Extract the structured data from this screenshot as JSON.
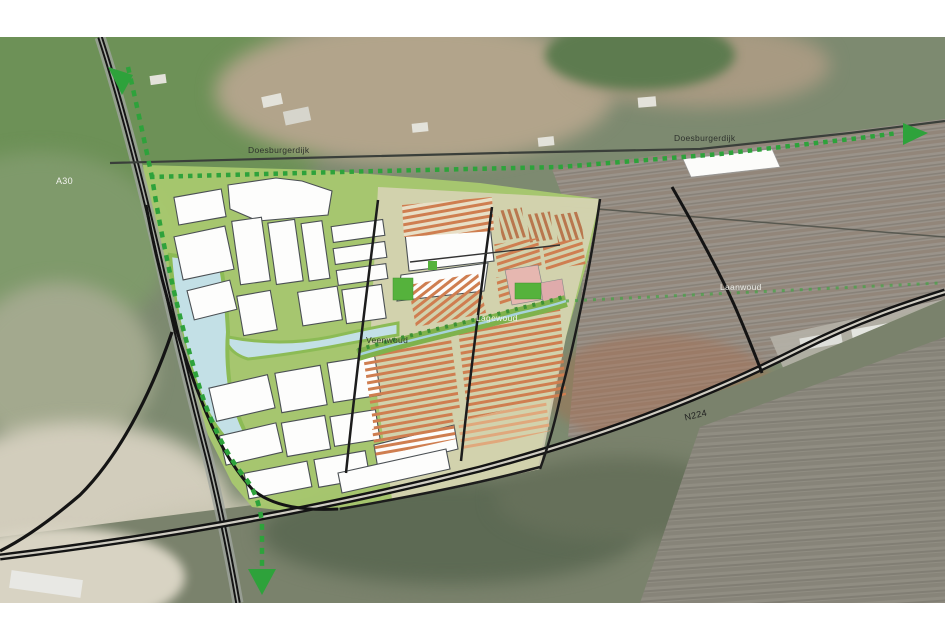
{
  "map": {
    "title": "satellite-master-plan-map",
    "labels": {
      "highway_a30": "A30",
      "road_n224": "N224",
      "dijk_west": "Doesburgerdijk",
      "dijk_east": "Doesburgerdijk",
      "district_veenwoud": "Veenwoud",
      "district_lagewoud": "Lagewoud",
      "district_laanwoud": "Laanwoud"
    },
    "colors": {
      "plan_green": "#a9c96f",
      "water_blue": "#c3e0e6",
      "route_green": "#2ea23b",
      "road_black": "#141414",
      "housing_orange": "#cf7e50",
      "block_white": "#fdfdfc"
    },
    "icons": {
      "route_arrows": [
        "arrow-up-left",
        "arrow-right",
        "arrow-down"
      ]
    }
  }
}
